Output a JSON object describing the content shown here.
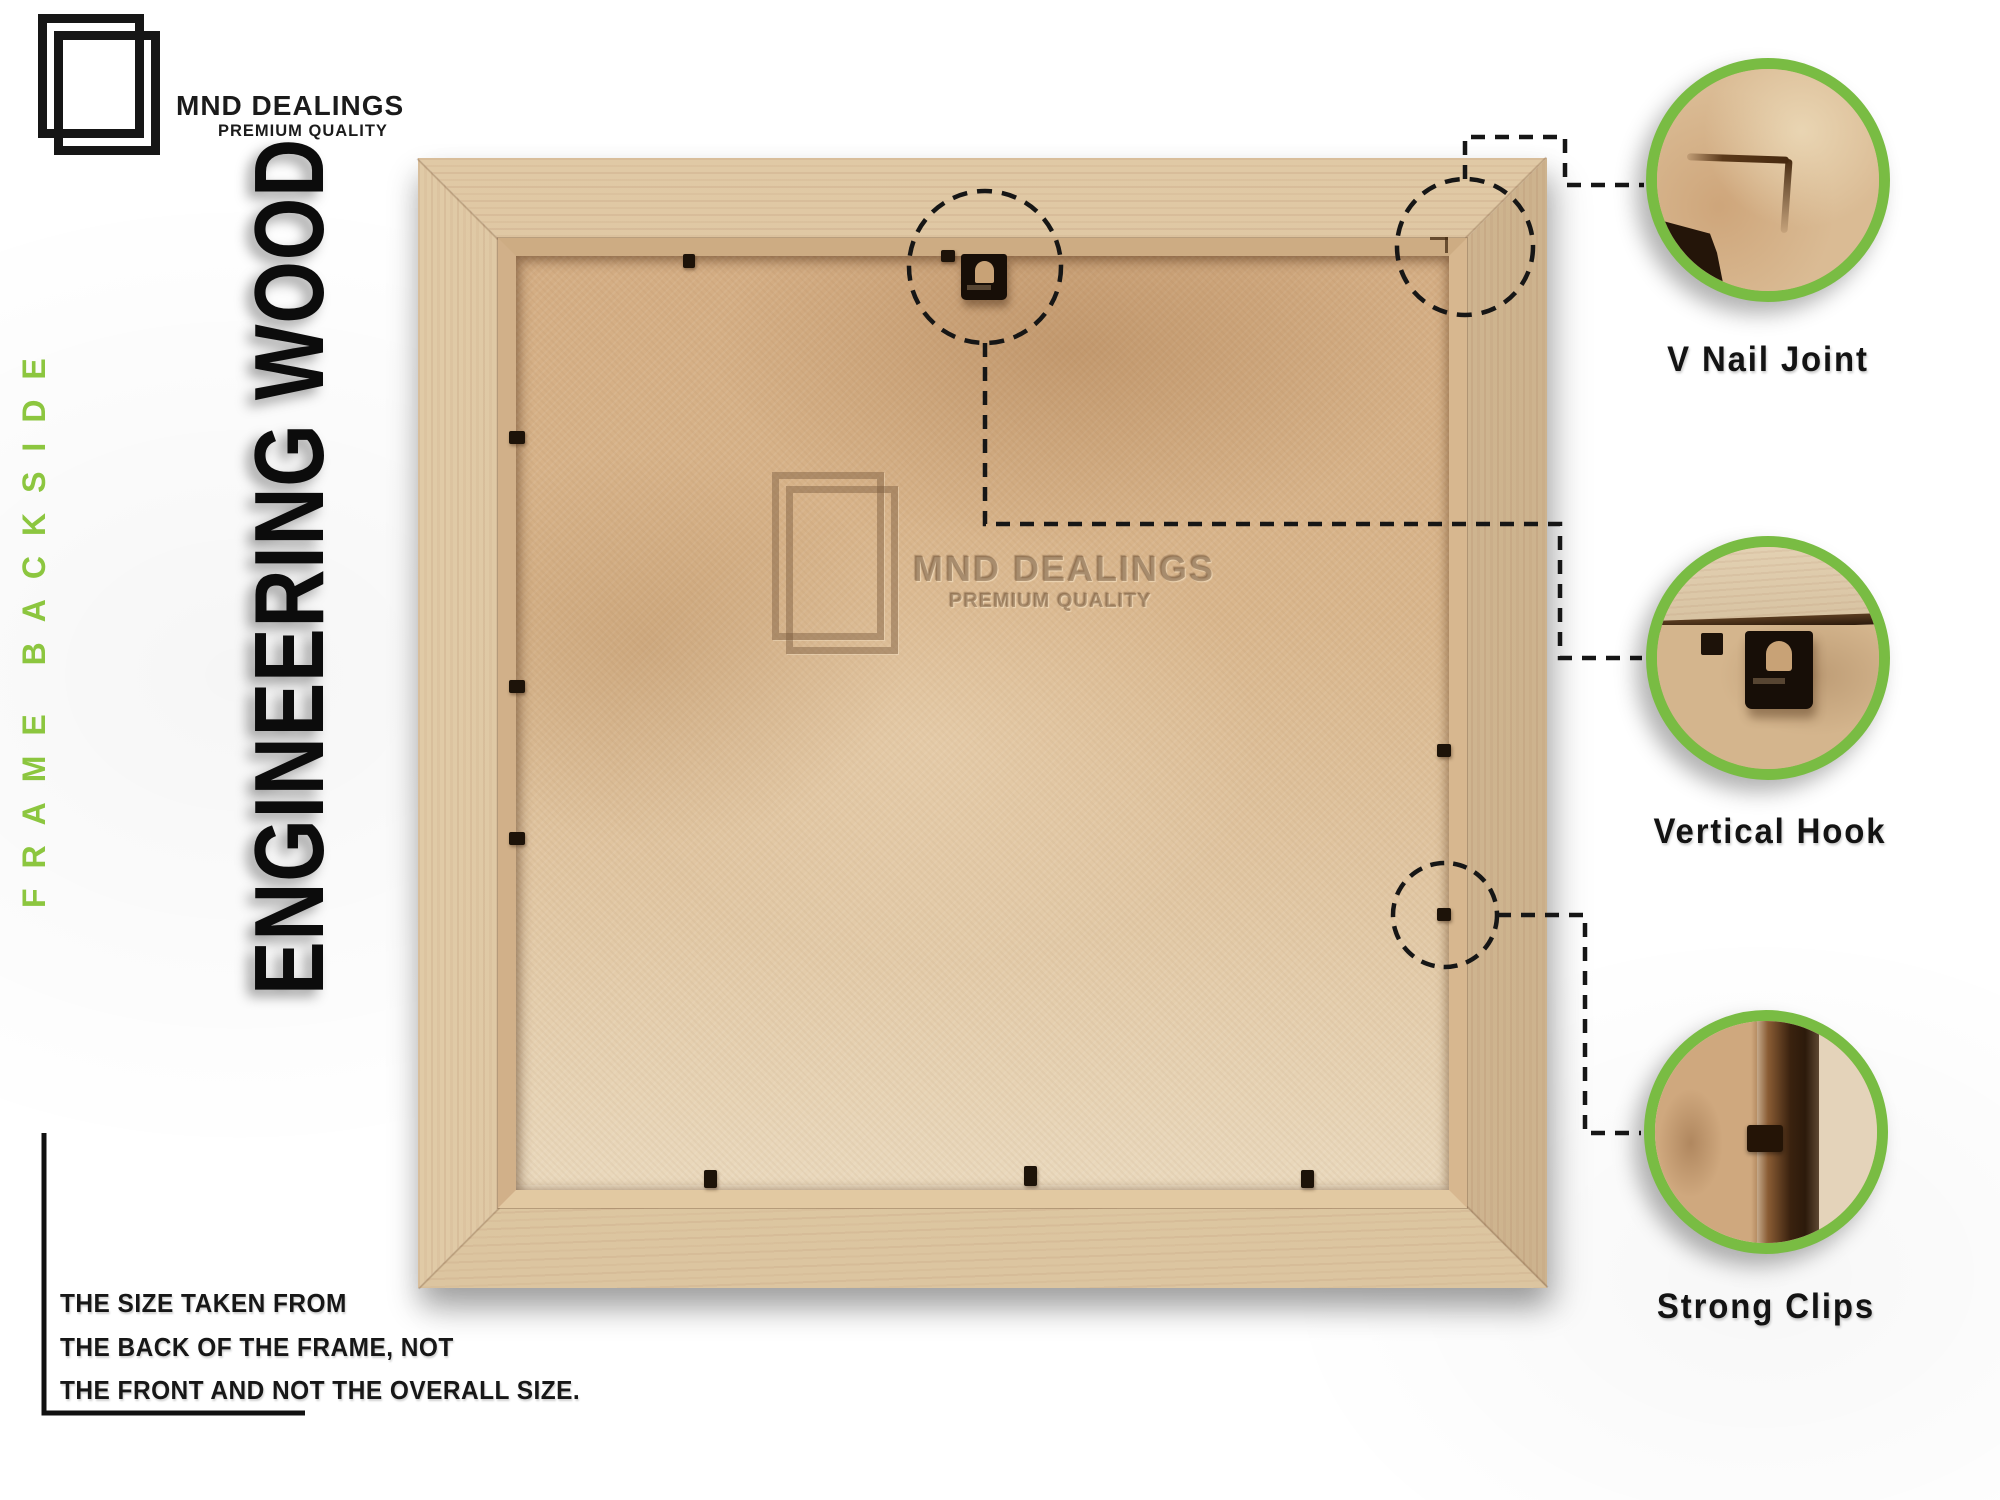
{
  "brand": {
    "name": "MND DEALINGS",
    "tagline": "PREMIUM QUALITY"
  },
  "side_label": "FRAME BACKSIDE",
  "material_label": "ENGINEERING WOOD",
  "watermark": {
    "name": "MND DEALINGS",
    "tagline": "PREMIUM QUALITY"
  },
  "callouts": [
    {
      "label": "V Nail Joint"
    },
    {
      "label": "Vertical Hook"
    },
    {
      "label": "Strong Clips"
    }
  ],
  "note": {
    "lines": [
      "THE SIZE TAKEN FROM",
      "THE BACK OF THE FRAME, NOT",
      "THE FRONT AND NOT THE OVERALL SIZE."
    ]
  },
  "colors": {
    "accent_green": "#8CC63F",
    "ring_green": "#79BC43",
    "wood": "#D9C29E",
    "mdf": "#D8B58C",
    "ink": "#141414"
  }
}
